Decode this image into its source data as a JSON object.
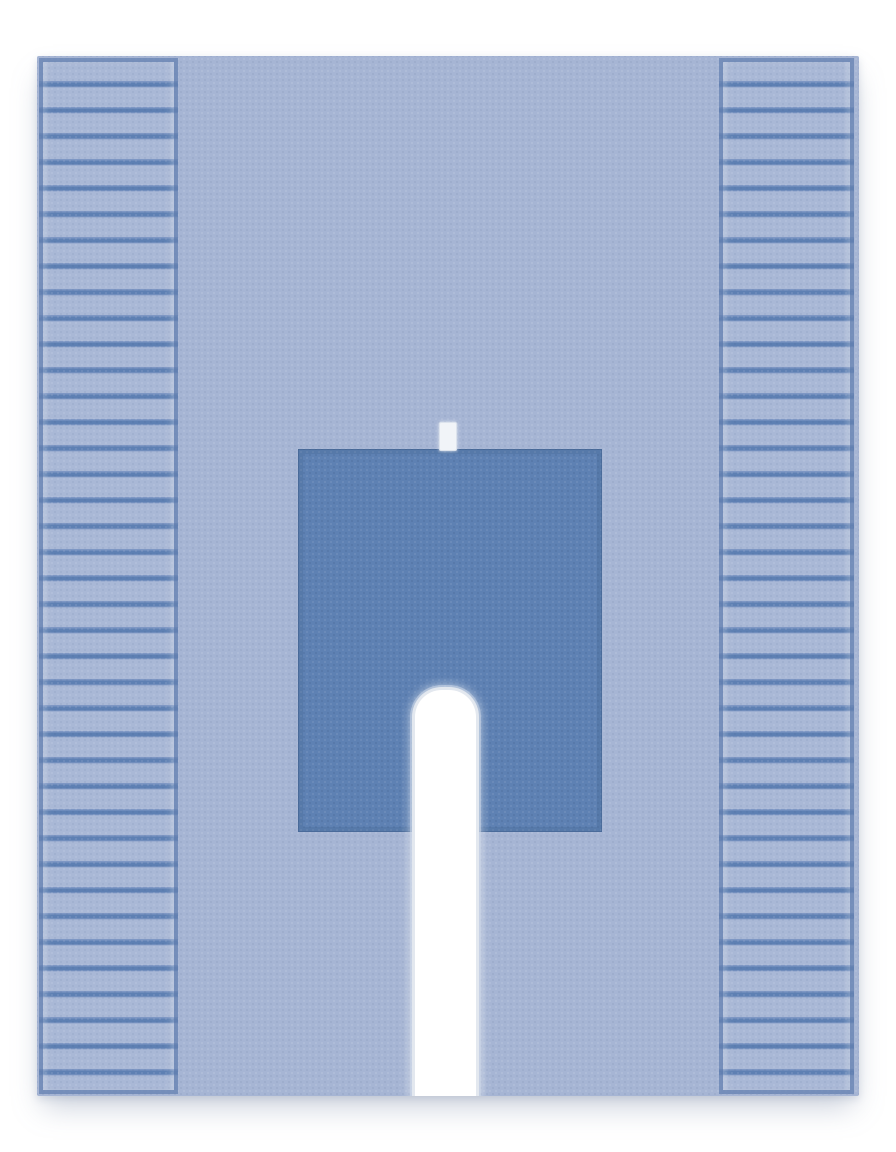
{
  "canvas": {
    "background": "#ffffff"
  },
  "colors": {
    "bg": "#ffffff",
    "drape-body": "#a6b5d4",
    "pleat-bar": "#a9b8d6",
    "pleat-line": "#5e80b3",
    "pleat-line-soft": "#7e97c4",
    "panel-frame": "rgba(100,128,176,0.75)",
    "patch": "#5e81b3",
    "patch-seam": "rgba(60,90,135,0.45)",
    "tab-fill": "#f1f4f8",
    "tab-border": "#dce3ed",
    "slot-fill": "#ffffff",
    "slot-border": "#e3e8ef",
    "slot-halo": "rgba(204,215,231,0.55)",
    "shadow": "rgba(120,135,165,0.40)"
  },
  "scene": {
    "subject": "surgical-drape-product-photo",
    "parts": [
      {
        "name": "pleated-fold-panel-left"
      },
      {
        "name": "pleated-fold-panel-right"
      },
      {
        "name": "reinforcement-patch"
      },
      {
        "name": "adhesive-tab"
      },
      {
        "name": "u-shaped-fenestration-slot"
      }
    ]
  }
}
